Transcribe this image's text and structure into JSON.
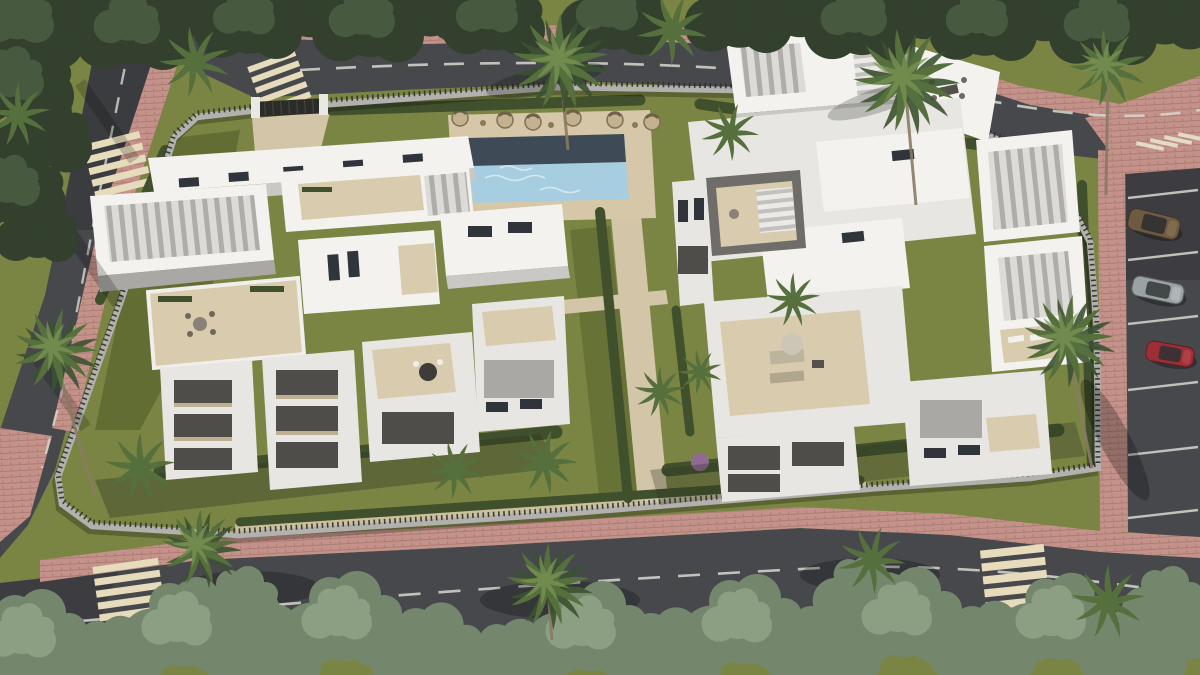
{
  "meta": {
    "title": "Aerial 3D render of a modern white residential complex",
    "description": "Bird's-eye architectural visualization: two white multi-level apartment buildings with roof terraces and louvered pergolas, a rectangular lap pool with sun loungers, landscaped gardens with palm trees and hedges, a perimeter wall with metal fence, surrounding asphalt roads with pedestrian crossings, pink brick sidewalks and a parking strip with three parked cars."
  },
  "palette": {
    "asphalt": "#47484c",
    "asphalt_dark": "#35363a",
    "sidewalk": "#c08d82",
    "sidewalk_dark": "#9c6f66",
    "stripe": "#e6dcbc",
    "road_line": "#d8d8d0",
    "lawn": "#7a8544",
    "lawn_shadow": "#505c2d",
    "hedge": "#41502c",
    "hedge_dark": "#303c22",
    "tree_dark": "#33402e",
    "tree_mid": "#4c5e42",
    "tree_light": "#657a59",
    "tree_pale": "#74876d",
    "tree_pale_light": "#93a689",
    "palm": "#55703c",
    "palm_dark": "#3c5230",
    "palm_light": "#7b9455",
    "wall": "#b2b1ad",
    "picket": "#2e2e2b",
    "bldg_top": "#f3f2ee",
    "bldg_lit": "#e7e6e2",
    "bldg_shade": "#c9c8c4",
    "bldg_shadow": "#a9a8a4",
    "bldg_deep": "#6e6d69",
    "recess": "#4e4d49",
    "terrace": "#d8cbae",
    "terrace_shade": "#bdb091",
    "window": "#2f353b",
    "pool_water": "#a7cde0",
    "pool_deep": "#3e4a55",
    "pool_sparkle": "#e9f4f8",
    "deck": "#d5c7a8",
    "path_beige": "#d3c6a8",
    "car_brown": "#6e5a40",
    "car_silver": "#9aa2a4",
    "car_red": "#9c2f35",
    "gate": "#2b2b29",
    "flower_bush": "#8f6b92"
  },
  "scene": {
    "buildings": [
      {
        "id": "left-residential-block",
        "description": "white modern block with stepped balconies, roof terraces, louvered pergolas"
      },
      {
        "id": "right-residential-block",
        "description": "white modern block with central courtyard, exterior stairs, pergola terraces"
      }
    ],
    "amenities": {
      "swimming_pool": {
        "shape": "rectangular lap pool",
        "deck": "sand-beige paving"
      },
      "sun_loungers_count": 6,
      "garden": "lawns, beige walkways, clipped hedges, flowering purple bush"
    },
    "roads": {
      "top_road": "two-lane asphalt, dashed centerline, curves to the right edge",
      "bottom_road": "two-lane asphalt, dashed centerline, tree-lined",
      "left_road": "two-lane asphalt descending the left edge",
      "right_parking": "parking bays with white separator lines"
    },
    "crosswalks": [
      "top-entrance",
      "left-road",
      "bottom-left",
      "bottom-right"
    ],
    "vehicles": [
      {
        "id": "car-brown",
        "location": "right parking bay 1"
      },
      {
        "id": "car-silver",
        "location": "right parking bay 2"
      },
      {
        "id": "car-red",
        "location": "right parking bay 3"
      }
    ],
    "boundary": "light gray wall topped with dark metal pickets, dark entrance gate with white pillars at top-left",
    "vegetation": "dense street-tree canopy along top and bottom, many palm trees inside and along roads"
  }
}
